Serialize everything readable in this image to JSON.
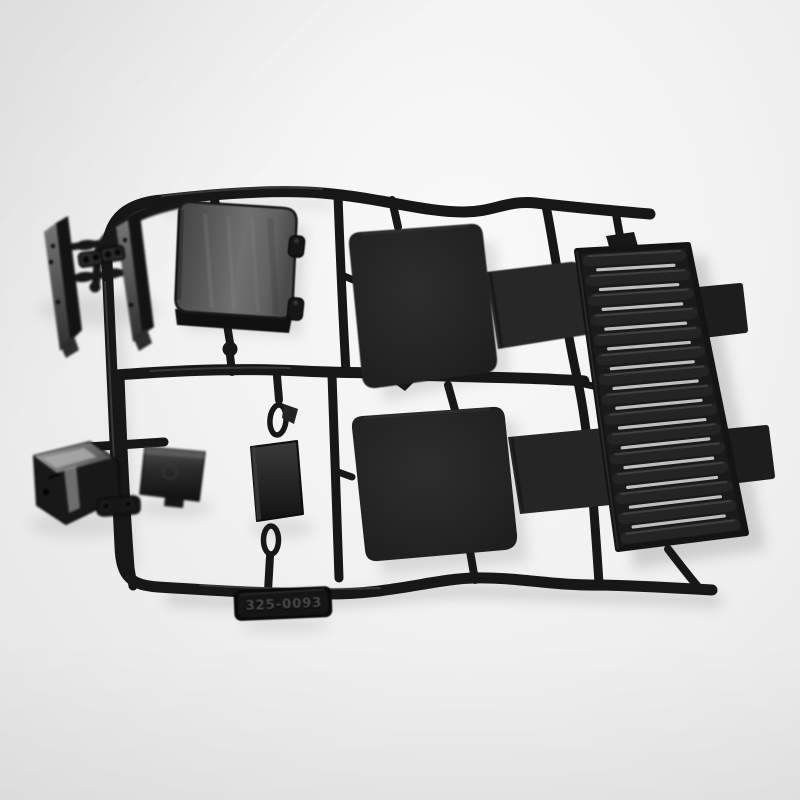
{
  "photo": {
    "alt": "Black injection-molded plastic model parts tree (sprue) photographed on a light gray background",
    "part_number": "325-0093"
  },
  "colors": {
    "background": "#f1f1f1",
    "background_edge": "#e4e4e4",
    "plastic": "#171717",
    "plastic_dark": "#0d0d0d",
    "plastic_mid": "#242424",
    "highlight": "#5f5f5f",
    "sheen": "#7a7a7a",
    "gap_light": "#dcdcdc",
    "shadow": "#c8c8c8",
    "tag_text": "#4a4a4a"
  },
  "louver": {
    "slat_count": 15
  },
  "parts": [
    "sprue-frame",
    "side-rail-left",
    "side-rail-right",
    "link-buckles",
    "storage-box",
    "box-clips",
    "seat-panel-upper",
    "seat-flap-upper",
    "seat-panel-lower",
    "seat-flap-lower",
    "louver-panel",
    "jerry-can",
    "flat-plate",
    "clamp-bracket",
    "center-plate",
    "part-number-tag"
  ]
}
